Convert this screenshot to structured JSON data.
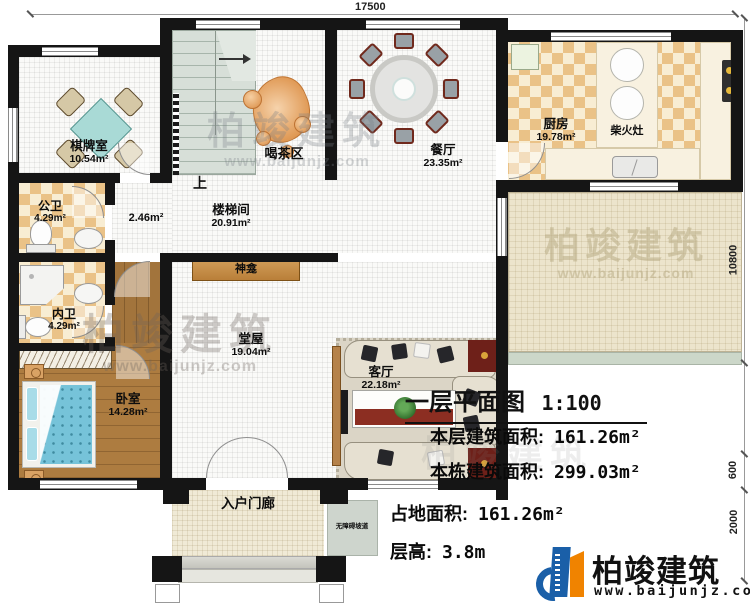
{
  "dimensions": {
    "top": "17500",
    "right": "10800",
    "right_mid": "600",
    "right_bottom": "2000"
  },
  "rooms": {
    "chess": {
      "name": "棋牌室",
      "area": "10.54m²"
    },
    "tea": {
      "name": "喝茶区"
    },
    "dining": {
      "name": "餐厅",
      "area": "23.35m²"
    },
    "kitchen": {
      "name": "厨房",
      "area": "19.78m²"
    },
    "wood_stove": {
      "name": "柴火灶"
    },
    "stair_hall": {
      "name": "楼梯间",
      "area": "20.91m²"
    },
    "hallway": {
      "area": "2.46m²"
    },
    "public_bath": {
      "name": "公卫",
      "area": "4.29m²"
    },
    "private_bath": {
      "name": "内卫",
      "area": "4.29m²"
    },
    "bedroom": {
      "name": "卧室",
      "area": "14.28m²"
    },
    "main_hall": {
      "name": "堂屋",
      "area": "19.04m²"
    },
    "living": {
      "name": "客厅",
      "area": "22.18m²"
    },
    "shrine": {
      "name": "神龛"
    },
    "porch": {
      "name": "入户门廊"
    },
    "ramp": {
      "name": "无障碍坡道"
    },
    "stairs_up_label": "上"
  },
  "info": {
    "title": "一层平面图",
    "scale": "1:100",
    "lines": [
      {
        "label": "本层建筑面积:",
        "value": "161.26m²"
      },
      {
        "label": "本栋建筑面积:",
        "value": "299.03m²"
      },
      {
        "label": "占地面积:",
        "value": "161.26m²"
      },
      {
        "label": "层高:",
        "value": "3.8m"
      }
    ]
  },
  "brand": {
    "name": "柏竣建筑",
    "url": "www.baijunjz.com"
  },
  "colors": {
    "wall": "#151515",
    "kitchen_tile": "#eac287",
    "wood": "#a9793d",
    "terrace": "#ece4cc",
    "porch": "#f0ead6",
    "brand_blue": "#1a5fa8",
    "brand_orange": "#f08300"
  }
}
